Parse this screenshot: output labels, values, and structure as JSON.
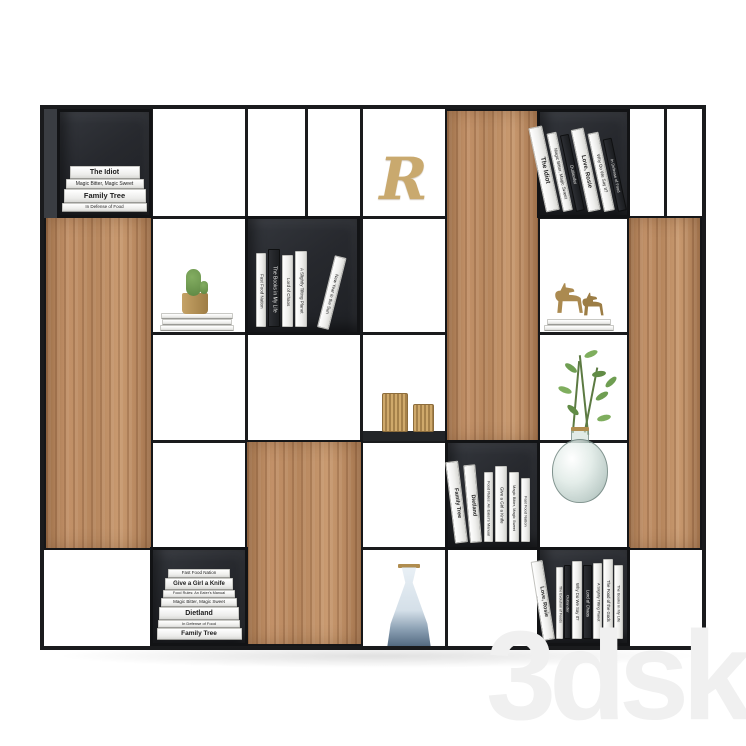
{
  "scene": {
    "title": "Black metal and wood shelving unit with books and decor",
    "watermark": "3dsky",
    "colors": {
      "background": "#ffffff",
      "frame": "#1a1b1d",
      "box_interior": "#26282c",
      "wood": "#bf8e63",
      "brass": "#b5925a",
      "leaf_green": "#6f9e52",
      "glass": "#cfdeda",
      "watermark_gray": "#f0f0f0"
    }
  },
  "books": {
    "top_left_stack": [
      "The Idiot",
      "Magic Bitter, Magic Sweet",
      "Family Tree",
      "In Defense of Food"
    ],
    "top_right_row": [
      "The Idiot",
      "Magic Bitter, Magic Sweet",
      "Outlander",
      "Love, Rosie",
      "Why Do We Say It?",
      "In Defense of Food"
    ],
    "mid_left_row": [
      "Fast Food Nation",
      "The Books in My Life",
      "Lord of Chaos",
      "A Slightly Tilting Planet",
      "New Year in the Sun"
    ],
    "center_row": [
      "Family Tree",
      "Dietland",
      "Food Rules: An Eater's Manual",
      "Give a Girl a Knife",
      "Magic Bitter, Magic Sweet",
      "Fast Food Nation"
    ],
    "bottom_left_stack": [
      "Fast Food Nation",
      "Give a Girl a Knife",
      "Food Rules: An Eater's Manual",
      "Magic Bitter, Magic Sweet",
      "Dietland",
      "In Defense of Food",
      "Family Tree"
    ],
    "bottom_right_row": [
      "Love, Rosie",
      "The Evolution of Foods",
      "Outlander",
      "Why Do We Say It?",
      "Lord of Chaos",
      "A Slightly Tilting Planet",
      "The Food of the Gods",
      "The Books in My Life"
    ]
  },
  "decor": {
    "monogram_letter": "R",
    "objects": [
      "cactus in brass pot",
      "two brass horse figurines",
      "two brass candle holders",
      "glass vase with green branch",
      "glass carafe with gold rim"
    ]
  }
}
